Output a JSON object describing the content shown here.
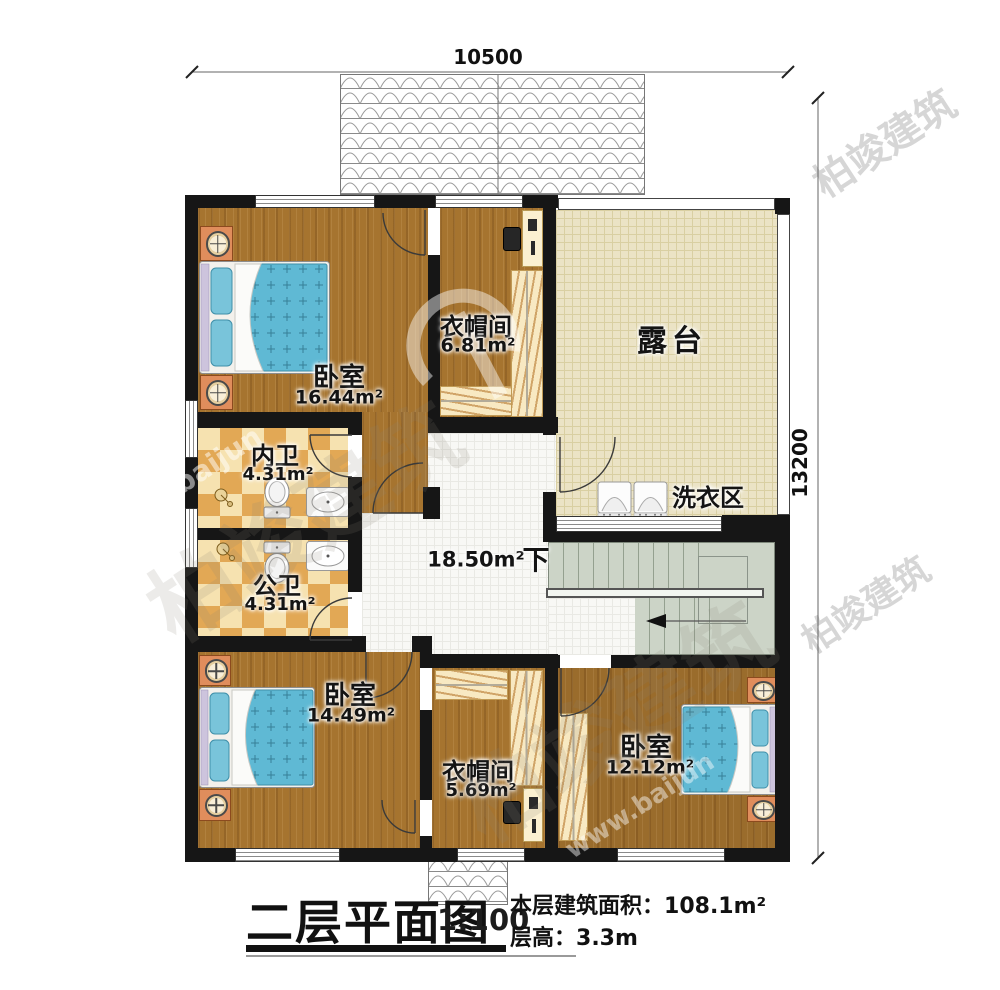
{
  "dimensions": {
    "width_mm": "10500",
    "height_mm": "13200"
  },
  "rooms": {
    "bedroom_tl": {
      "name": "卧室",
      "area": "16.44m²"
    },
    "cloakroom_top": {
      "name": "衣帽间",
      "area": "6.81m²"
    },
    "terrace": {
      "name": "露台"
    },
    "laundry": {
      "name": "洗衣区"
    },
    "bath_inner": {
      "name": "内卫",
      "area": "4.31m²"
    },
    "bath_public": {
      "name": "公卫",
      "area": "4.31m²"
    },
    "hall": {
      "area": "18.50m²"
    },
    "stairs": {
      "label": "下"
    },
    "bedroom_bl": {
      "name": "卧室",
      "area": "14.49m²"
    },
    "cloakroom_bottom": {
      "name": "衣帽间",
      "area": "5.69m²"
    },
    "bedroom_br": {
      "name": "卧室",
      "area": "12.12m²"
    }
  },
  "title_block": {
    "title": "二层平面图",
    "scale": "1:100",
    "area_label": "本层建筑面积：",
    "area_value": "108.1m²",
    "floor_height_label": "层高：",
    "floor_height_value": "3.3m"
  },
  "watermark": {
    "brand": "柏竣建筑",
    "url_fragment": "www.baijun"
  },
  "colors": {
    "wall": "#161616",
    "wood": "#a6742f",
    "checker_dark": "#e2a855",
    "checker_light": "#f6e2b0",
    "terrace": "#ebe3c5",
    "stairs": "#ccd4c7",
    "bed": "#5fb9d4",
    "wardrobe": "#f8e9c2",
    "nightstand": "#e08d5c"
  }
}
